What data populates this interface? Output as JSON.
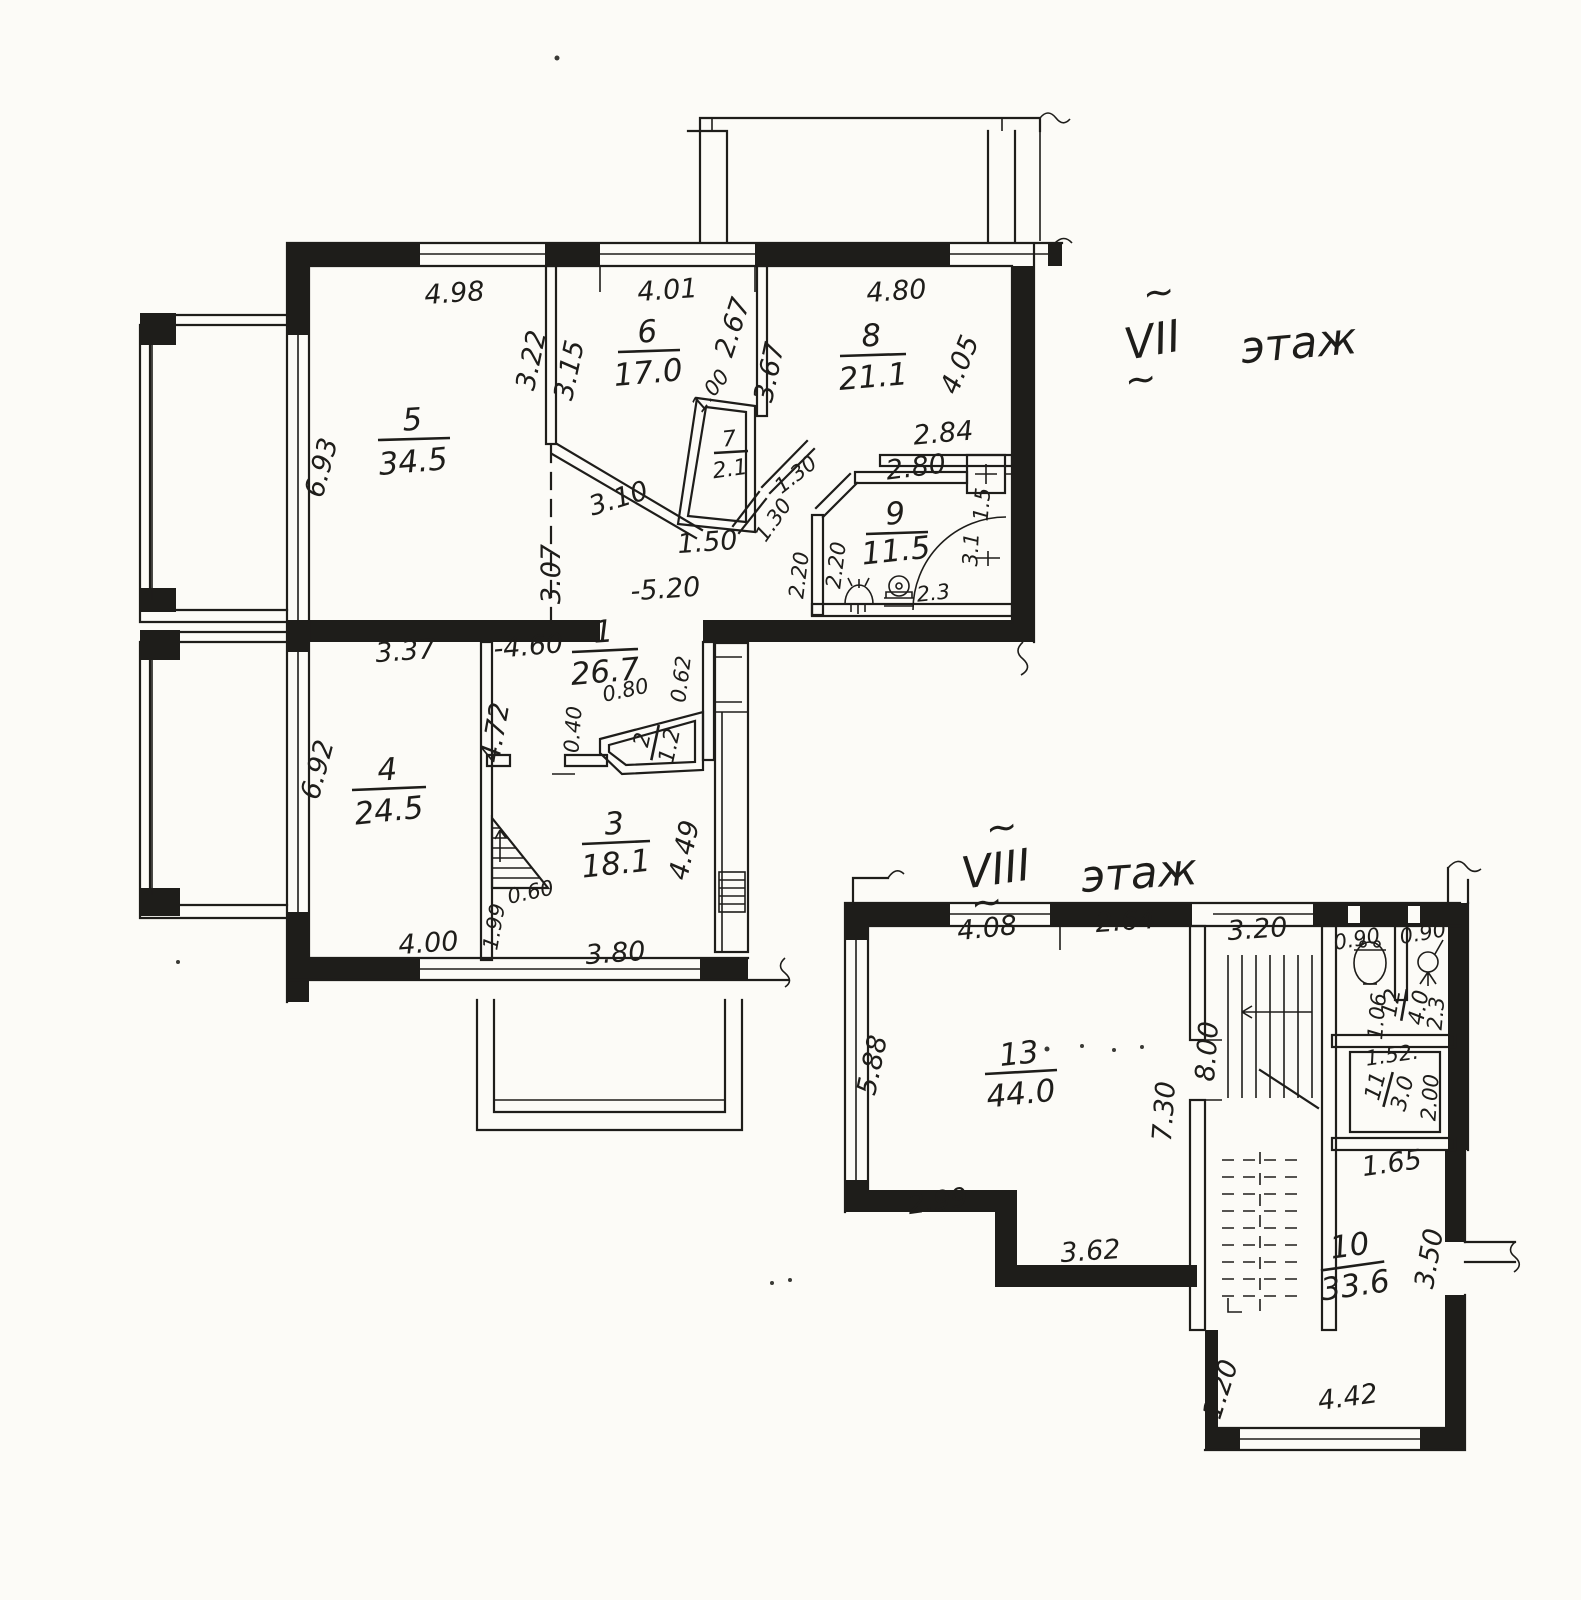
{
  "document": {
    "type": "scanned floor plan",
    "language": "ru"
  },
  "colors": {
    "ink": "#1e1d1a",
    "paper": "#fcfbf7"
  },
  "icons": {
    "stairs": "stairs-icon",
    "stairs_upper_flight": "stairs-up-flight-icon",
    "stairs_lower_flight": "stairs-down-flight-icon",
    "toilet": "toilet-icon",
    "bidet": "bidet-icon",
    "sink": "sink-icon",
    "shower": "shower-icon",
    "radiator": "radiator-icon",
    "corner_bath": "bath-arc-icon",
    "wall_break": "wall-break-icon",
    "direction_arrow": "arrow-icon"
  },
  "floor7": {
    "numeral": "VII",
    "word": "этаж",
    "tilde": "~",
    "rooms": [
      {
        "num": "5",
        "area": "34.5"
      },
      {
        "num": "6",
        "area": "17.0"
      },
      {
        "num": "7",
        "area": "2.1"
      },
      {
        "num": "8",
        "area": "21.1"
      },
      {
        "num": "9",
        "area": "11.5"
      },
      {
        "num": "1",
        "area": "26.7"
      },
      {
        "num": "2",
        "area": "1.2"
      },
      {
        "num": "4",
        "area": "24.5"
      },
      {
        "num": "3",
        "area": "18.1"
      }
    ],
    "dims": [
      "4.98",
      "4.01",
      "2.67",
      "4.80",
      "3.22",
      "3.15",
      "3.67",
      "4.05",
      "6.93",
      "1.00",
      "2.84",
      "2.80",
      "1.30",
      "1.30",
      "3.10",
      "1.50",
      "3.07",
      "-5.20",
      "2.20",
      "2.20",
      "2.3",
      "3.1",
      "1.5",
      "-4.60",
      "0.62",
      "0.80",
      "0.40",
      "3.37",
      "6.92",
      "4.72",
      "4.49",
      "0.60",
      "1.99",
      "4.00",
      "3.80"
    ]
  },
  "floor8": {
    "numeral": "VIII",
    "word": "этаж",
    "tilde": "~",
    "rooms": [
      {
        "num": "13",
        "area": "44.0"
      },
      {
        "num": "12",
        "area": "4.0"
      },
      {
        "num": "11",
        "area": "3.0"
      },
      {
        "num": "10",
        "area": "33.6"
      }
    ],
    "dims": [
      "4.08",
      "2.64",
      "3.20",
      "0.90",
      "0.90",
      "5.88",
      "7.30",
      "8.00",
      "1.06",
      "2.3",
      "1.52.",
      "2.00",
      "1.65",
      "2.99",
      "3.62",
      "3.50",
      "1.20",
      "4.42"
    ]
  }
}
